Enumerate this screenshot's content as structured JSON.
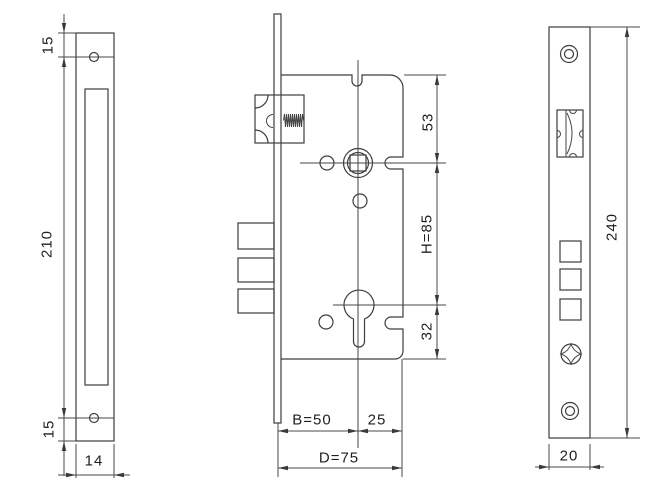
{
  "drawing": {
    "subject": "mortise-lock-technical-drawing",
    "ink_color": "#3d3d3d",
    "views": {
      "faceplate_side": {
        "top_hole_offset": "15",
        "body_length": "210",
        "bottom_hole_offset": "15",
        "plate_width": "14"
      },
      "lock_body": {
        "top_to_spindle": "53",
        "spindle_to_cylinder": "H=85",
        "cylinder_to_bottom": "32",
        "backset": "B=50",
        "backset_to_rear": "25",
        "case_depth": "D=75"
      },
      "faceplate_front": {
        "plate_length": "240",
        "plate_width": "20"
      }
    }
  }
}
